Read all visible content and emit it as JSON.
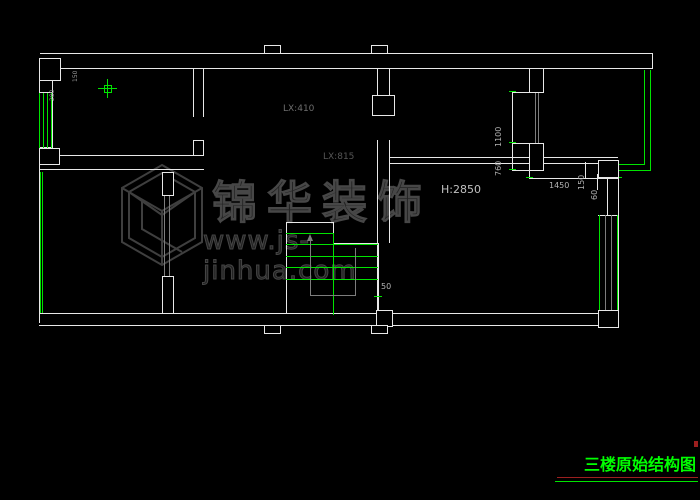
{
  "drawing": {
    "labels": {
      "lx410": "LX:410",
      "lx815": "LX:815",
      "height": "H:2850"
    },
    "dimensions": {
      "d1100": "1100",
      "d760": "760",
      "d1450": "1450",
      "d150_right": "150",
      "d60": "60",
      "d50": "50",
      "d150_left": "150",
      "d280": "280"
    },
    "watermark": {
      "brand": "锦华装饰",
      "url": "www.js-jinhua.com"
    },
    "title_block": {
      "text": "三楼原始结构图"
    },
    "colors": {
      "wall": "#e8e8e8",
      "window": "#00e400",
      "opening_gray": "#7d7d7d",
      "title_green": "#00ff00",
      "underline_red": "#9c1f1f",
      "watermark_gray": "#474747",
      "background": "#000000"
    }
  }
}
